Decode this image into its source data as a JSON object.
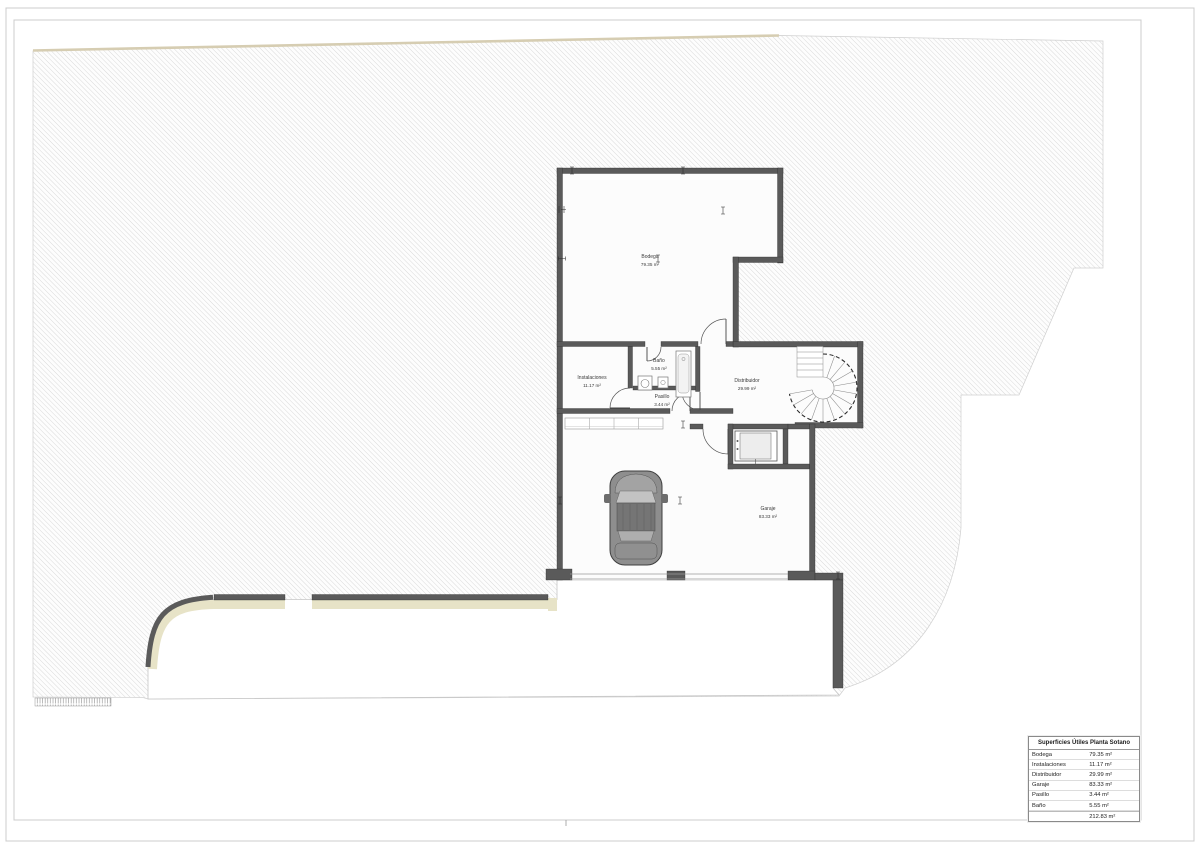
{
  "rooms": [
    {
      "name": "Bodega",
      "area": "79.35 m²"
    },
    {
      "name": "Instalaciones",
      "area": "11.17 m²"
    },
    {
      "name": "Baño",
      "area": "5.55 m²"
    },
    {
      "name": "Pasillo",
      "area": "3.44 m²"
    },
    {
      "name": "Distribuidor",
      "area": "29.99 m²"
    },
    {
      "name": "Garaje",
      "area": "83.33 m²"
    }
  ],
  "table": {
    "header": "Superficies Útiles Planta Sotano",
    "rows": [
      {
        "label": "Bodega",
        "value": "79.35 m²"
      },
      {
        "label": "Instalaciones",
        "value": "11.17 m²"
      },
      {
        "label": "Distribuidor",
        "value": "29.99 m²"
      },
      {
        "label": "Garaje",
        "value": "83.33 m²"
      },
      {
        "label": "Pasillo",
        "value": "3.44 m²"
      },
      {
        "label": "Baño",
        "value": "5.55 m²"
      },
      {
        "label": "",
        "value": "212.83 m²"
      }
    ]
  },
  "colors": {
    "wall": "#5a5a5a",
    "hatchline": "#d7d7d7",
    "beige": "#e7e3c7",
    "beigeline": "#d6cdb2",
    "frame": "#cccccc",
    "roomfill": "#fcfcfc",
    "label": "#3a3a3a"
  }
}
